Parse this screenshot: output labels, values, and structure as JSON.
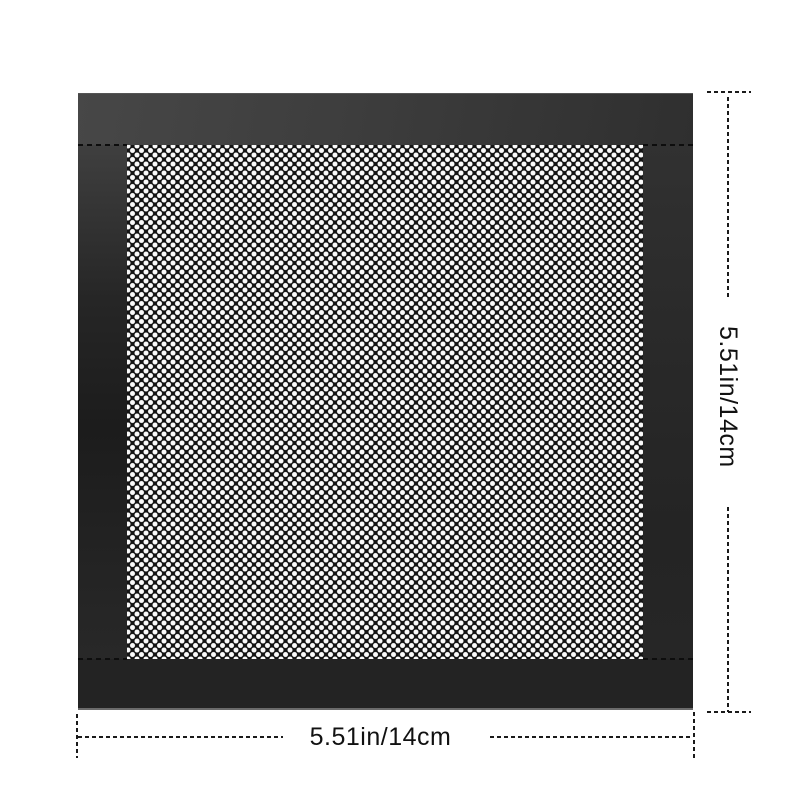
{
  "image_type": "product-dimension-diagram",
  "product": {
    "item": "magnetic-mesh-dust-filter-panel",
    "mesh_pattern": "staggered-round-perforations"
  },
  "dimensions": {
    "height_label": "5.51in/14cm",
    "width_label": "5.51in/14cm"
  },
  "colors": {
    "background": "#ffffff",
    "frame_dark": "#262626",
    "frame_light": "#474747",
    "mesh_base": "#141414",
    "mesh_dot": "#fafafa",
    "dimension_line": "#1a1a1a",
    "label_text": "#111111"
  }
}
